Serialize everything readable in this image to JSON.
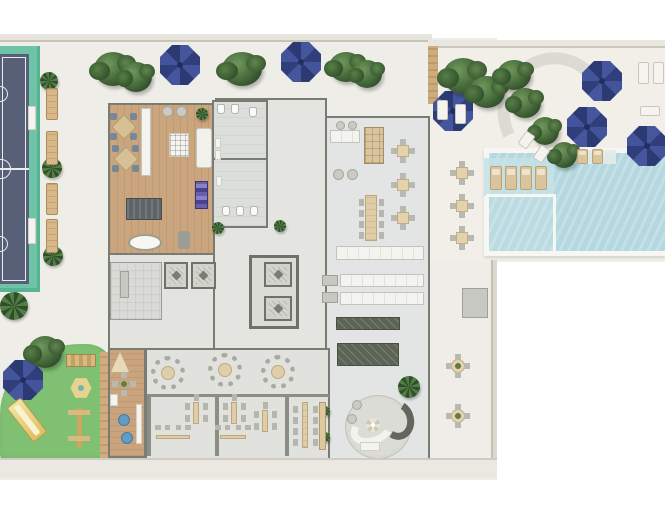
{
  "meta": {
    "description": "Top-down architectural floor plan rendering of a residential amenities level",
    "canvas": {
      "width": 665,
      "height": 515
    }
  },
  "palette": {
    "background": "#ffffff",
    "terrace": "#efede7",
    "court_surface": "#586078",
    "court_border": "#6fc3a6",
    "court_lines": "#e8ecf2",
    "wood_floor": "#caa57d",
    "building_floor": "#e3e4e1",
    "wall": "#787c72",
    "pool_water": "#b4d8df",
    "pool_coping": "#f7f6f2",
    "lawn": "#7fc073",
    "umbrella_navy": "#3a4a8c",
    "tree_green": "#4a6f3e",
    "furniture_tan": "#e0cda6",
    "dark_counter": "#5c6456",
    "kids_pouf_blue": "#5f9dc4",
    "play_equipment_yellow": "#e2c771"
  },
  "areas": [
    {
      "name": "sports-court",
      "bbox": [
        0,
        46,
        40,
        246
      ]
    },
    {
      "name": "planter-bench-row",
      "bbox": [
        46,
        88,
        12,
        165
      ]
    },
    {
      "name": "terrace-main",
      "bbox": [
        0,
        38,
        497,
        442
      ]
    },
    {
      "name": "multipurpose-room-wood-floor",
      "bbox": [
        108,
        103,
        107,
        152
      ]
    },
    {
      "name": "restrooms-block",
      "bbox": [
        212,
        100,
        56,
        128
      ]
    },
    {
      "name": "corridor",
      "bbox": [
        265,
        128,
        62,
        110
      ]
    },
    {
      "name": "cafe-lounge-wing",
      "bbox": [
        325,
        116,
        105,
        140
      ]
    },
    {
      "name": "kitchen-service",
      "bbox": [
        322,
        240,
        108,
        130
      ]
    },
    {
      "name": "elevator-core",
      "bbox": [
        160,
        255,
        140,
        75
      ]
    },
    {
      "name": "dining-hall",
      "bbox": [
        145,
        348,
        285,
        112
      ]
    },
    {
      "name": "private-dining-booths",
      "bbox": [
        147,
        394,
        182,
        62
      ]
    },
    {
      "name": "kids-playroom",
      "bbox": [
        108,
        348,
        38,
        110
      ]
    },
    {
      "name": "circular-lounge",
      "bbox": [
        345,
        395,
        66,
        64
      ]
    },
    {
      "name": "playground-lawn",
      "bbox": [
        0,
        344,
        112,
        120
      ]
    },
    {
      "name": "pool",
      "bbox": [
        484,
        148,
        181,
        108
      ]
    },
    {
      "name": "pool-deck",
      "bbox": [
        430,
        40,
        235,
        222
      ]
    },
    {
      "name": "outdoor-dining-east",
      "bbox": [
        440,
        155,
        50,
        100
      ]
    },
    {
      "name": "outdoor-tables-southeast",
      "bbox": [
        440,
        350,
        50,
        90
      ]
    }
  ],
  "counts": {
    "navy_umbrellas": 7,
    "round_tables_6_seat": 3,
    "square_tables_4_seat": 6,
    "round_tables_4_seat": 3,
    "pool_in_water_loungers": 4,
    "elevators": 4
  },
  "sprites": [
    {
      "t": "umbrella",
      "n": "terrace-umbrella",
      "x": 160,
      "y": 45
    },
    {
      "t": "umbrella",
      "n": "terrace-umbrella",
      "x": 281,
      "y": 42
    },
    {
      "t": "umbrella",
      "n": "pool-deck-umbrella",
      "x": 433,
      "y": 91
    },
    {
      "t": "umbrella",
      "n": "pool-deck-umbrella",
      "x": 582,
      "y": 61
    },
    {
      "t": "umbrella",
      "n": "pool-deck-umbrella",
      "x": 567,
      "y": 107
    },
    {
      "t": "umbrella",
      "n": "pool-deck-umbrella",
      "x": 627,
      "y": 126
    },
    {
      "t": "umbrella",
      "n": "lawn-umbrella",
      "x": 3,
      "y": 360
    },
    {
      "t": "tree",
      "x": 94,
      "y": 52,
      "w": 38,
      "h": 34
    },
    {
      "t": "tree",
      "x": 120,
      "y": 62,
      "w": 32,
      "h": 30
    },
    {
      "t": "tree",
      "x": 222,
      "y": 52,
      "w": 40,
      "h": 34
    },
    {
      "t": "tree",
      "x": 329,
      "y": 52,
      "w": 34,
      "h": 30
    },
    {
      "t": "tree",
      "x": 352,
      "y": 60,
      "w": 30,
      "h": 28
    },
    {
      "t": "tree",
      "x": 443,
      "y": 58,
      "w": 40,
      "h": 36
    },
    {
      "t": "tree",
      "x": 469,
      "y": 76,
      "w": 36,
      "h": 32
    },
    {
      "t": "tree",
      "x": 497,
      "y": 60,
      "w": 34,
      "h": 30
    },
    {
      "t": "tree",
      "x": 509,
      "y": 88,
      "w": 32,
      "h": 30
    },
    {
      "t": "tree",
      "x": 531,
      "y": 117,
      "w": 28,
      "h": 28
    },
    {
      "t": "tree",
      "x": 551,
      "y": 142,
      "w": 26,
      "h": 26
    },
    {
      "t": "tree",
      "x": 28,
      "y": 336,
      "w": 34,
      "h": 32
    },
    {
      "t": "palm",
      "x": 0,
      "y": 292,
      "w": 28,
      "h": 28
    },
    {
      "t": "palm",
      "x": 40,
      "y": 72,
      "w": 18,
      "h": 18
    },
    {
      "t": "palm",
      "x": 42,
      "y": 158,
      "w": 20,
      "h": 20
    },
    {
      "t": "palm",
      "x": 43,
      "y": 246,
      "w": 20,
      "h": 20
    },
    {
      "t": "palm",
      "x": 196,
      "y": 108,
      "w": 12,
      "h": 12
    },
    {
      "t": "palm",
      "x": 212,
      "y": 222,
      "w": 12,
      "h": 12
    },
    {
      "t": "palm",
      "x": 274,
      "y": 220,
      "w": 12,
      "h": 12
    },
    {
      "t": "palm",
      "x": 398,
      "y": 376,
      "w": 22,
      "h": 22
    },
    {
      "t": "palm",
      "x": 320,
      "y": 406,
      "w": 10,
      "h": 10
    },
    {
      "t": "palm",
      "x": 320,
      "y": 432,
      "w": 10,
      "h": 10
    },
    {
      "t": "bench",
      "x": 46,
      "y": 88,
      "w": 12,
      "h": 32
    },
    {
      "t": "bench",
      "x": 46,
      "y": 131,
      "w": 12,
      "h": 34
    },
    {
      "t": "bench",
      "x": 46,
      "y": 183,
      "w": 12,
      "h": 32
    },
    {
      "t": "bench",
      "x": 46,
      "y": 219,
      "w": 12,
      "h": 34
    },
    {
      "t": "pad",
      "x": 28,
      "y": 106,
      "w": 8,
      "h": 24
    },
    {
      "t": "pad",
      "x": 28,
      "y": 218,
      "w": 8,
      "h": 26
    },
    {
      "t": "lounger",
      "n": "pool-lounger",
      "x": 490,
      "y": 166,
      "w": 12,
      "h": 24
    },
    {
      "t": "lounger",
      "n": "pool-lounger",
      "x": 505,
      "y": 166,
      "w": 12,
      "h": 24
    },
    {
      "t": "lounger",
      "n": "pool-lounger",
      "x": 520,
      "y": 166,
      "w": 12,
      "h": 24
    },
    {
      "t": "lounger",
      "n": "pool-lounger",
      "x": 535,
      "y": 166,
      "w": 12,
      "h": 24
    },
    {
      "t": "lounger",
      "x": 577,
      "y": 149,
      "w": 11,
      "h": 15
    },
    {
      "t": "lounger",
      "x": 592,
      "y": 149,
      "w": 11,
      "h": 15
    },
    {
      "t": "lounger-w",
      "x": 638,
      "y": 62,
      "w": 11,
      "h": 22
    },
    {
      "t": "lounger-w",
      "x": 653,
      "y": 62,
      "w": 11,
      "h": 22
    },
    {
      "t": "lounger-w",
      "x": 640,
      "y": 106,
      "w": 20,
      "h": 10
    },
    {
      "t": "lounger-w",
      "x": 437,
      "y": 100,
      "w": 11,
      "h": 20
    },
    {
      "t": "lounger-w",
      "x": 455,
      "y": 104,
      "w": 11,
      "h": 20
    },
    {
      "t": "lounger-w",
      "x": 521,
      "y": 132,
      "w": 11,
      "h": 16,
      "r": 35
    },
    {
      "t": "lounger-w",
      "x": 536,
      "y": 146,
      "w": 11,
      "h": 16,
      "r": 35
    },
    {
      "t": "table4",
      "n": "outdoor-table",
      "x": 452,
      "y": 163
    },
    {
      "t": "table4",
      "n": "outdoor-table",
      "x": 452,
      "y": 196
    },
    {
      "t": "table4",
      "n": "outdoor-table",
      "x": 452,
      "y": 228
    },
    {
      "t": "table-r4",
      "n": "outdoor-round-table",
      "x": 447,
      "y": 355
    },
    {
      "t": "table-r4",
      "n": "outdoor-round-table",
      "x": 447,
      "y": 405
    },
    {
      "t": "table4",
      "n": "cafe-table",
      "x": 393,
      "y": 141
    },
    {
      "t": "table4",
      "n": "cafe-table",
      "x": 393,
      "y": 175
    },
    {
      "t": "table4",
      "n": "cafe-table",
      "x": 393,
      "y": 208
    },
    {
      "t": "longtable",
      "n": "communal-table",
      "x": 359,
      "y": 193,
      "w": 24,
      "h": 50
    },
    {
      "t": "chair",
      "x": 336,
      "y": 121,
      "w": 9,
      "h": 9
    },
    {
      "t": "chair",
      "x": 348,
      "y": 121,
      "w": 9,
      "h": 9
    },
    {
      "t": "counter",
      "x": 330,
      "y": 130,
      "w": 30,
      "h": 13
    },
    {
      "t": "cabinet",
      "x": 364,
      "y": 127,
      "w": 20,
      "h": 37
    },
    {
      "t": "chair",
      "x": 333,
      "y": 169,
      "w": 11,
      "h": 11
    },
    {
      "t": "chair",
      "x": 347,
      "y": 169,
      "w": 11,
      "h": 11
    },
    {
      "t": "counter",
      "x": 336,
      "y": 246,
      "w": 88,
      "h": 14
    },
    {
      "t": "counter",
      "x": 340,
      "y": 274,
      "w": 84,
      "h": 13
    },
    {
      "t": "counter",
      "x": 340,
      "y": 292,
      "w": 84,
      "h": 13
    },
    {
      "t": "graybox",
      "x": 322,
      "y": 275,
      "w": 16,
      "h": 11
    },
    {
      "t": "graybox",
      "x": 322,
      "y": 292,
      "w": 16,
      "h": 11
    },
    {
      "t": "darkcounter",
      "n": "kitchen-island",
      "x": 336,
      "y": 317,
      "w": 64,
      "h": 13
    },
    {
      "t": "darkcounter",
      "n": "buffet-counter",
      "x": 337,
      "y": 343,
      "w": 62,
      "h": 23
    },
    {
      "t": "xdesk",
      "n": "workstation-cluster",
      "x": 108,
      "y": 112,
      "w": 30,
      "h": 28
    },
    {
      "t": "xdesk",
      "n": "workstation-cluster",
      "x": 110,
      "y": 144,
      "w": 30,
      "h": 28
    },
    {
      "t": "counter",
      "x": 141,
      "y": 108,
      "w": 10,
      "h": 68
    },
    {
      "t": "gridtable",
      "x": 169,
      "y": 133,
      "w": 20,
      "h": 24
    },
    {
      "t": "sofa",
      "x": 196,
      "y": 128,
      "w": 16,
      "h": 40
    },
    {
      "t": "rack",
      "n": "equipment-rack",
      "x": 195,
      "y": 181,
      "w": 13,
      "h": 28
    },
    {
      "t": "darktable",
      "x": 126,
      "y": 198,
      "w": 36,
      "h": 22
    },
    {
      "t": "oval",
      "n": "massage-table",
      "x": 128,
      "y": 234,
      "w": 34,
      "h": 17
    },
    {
      "t": "stool",
      "x": 178,
      "y": 231,
      "w": 12,
      "h": 18
    },
    {
      "t": "chair",
      "x": 162,
      "y": 106,
      "w": 11,
      "h": 11
    },
    {
      "t": "chair",
      "x": 176,
      "y": 106,
      "w": 11,
      "h": 11
    },
    {
      "t": "table-r6",
      "n": "dining-round-table",
      "x": 151,
      "y": 356
    },
    {
      "t": "table-r6",
      "n": "dining-round-table",
      "x": 208,
      "y": 353
    },
    {
      "t": "table-r6",
      "n": "dining-round-table",
      "x": 261,
      "y": 355
    },
    {
      "t": "vtable",
      "n": "booth-table",
      "x": 190,
      "y": 400,
      "w": 12,
      "h": 26
    },
    {
      "t": "vtable",
      "n": "booth-table",
      "x": 228,
      "y": 400,
      "w": 12,
      "h": 26
    },
    {
      "t": "vtable",
      "n": "booth-table",
      "x": 259,
      "y": 408,
      "w": 12,
      "h": 26
    },
    {
      "t": "banquette",
      "x": 154,
      "y": 431,
      "w": 38,
      "h": 12
    },
    {
      "t": "banquette",
      "x": 218,
      "y": 431,
      "w": 30,
      "h": 12
    },
    {
      "t": "longtable",
      "n": "dining-long-table",
      "x": 298,
      "y": 400,
      "w": 14,
      "h": 50
    },
    {
      "t": "console",
      "x": 319,
      "y": 402,
      "w": 7,
      "h": 48
    },
    {
      "t": "teepee",
      "x": 111,
      "y": 352,
      "w": 18,
      "h": 20
    },
    {
      "t": "table-r4",
      "n": "kids-table",
      "x": 116,
      "y": 376,
      "w": 16,
      "h": 16
    },
    {
      "t": "pad",
      "x": 110,
      "y": 394,
      "w": 8,
      "h": 12
    },
    {
      "t": "pad",
      "x": 136,
      "y": 404,
      "w": 6,
      "h": 40
    },
    {
      "t": "pouf",
      "x": 118,
      "y": 414
    },
    {
      "t": "pouf",
      "x": 121,
      "y": 432
    },
    {
      "t": "slide",
      "n": "playground-slide",
      "x": 18,
      "y": 398,
      "w": 18,
      "h": 44,
      "r": -38
    },
    {
      "t": "woodbar",
      "n": "climbing-frame",
      "x": 66,
      "y": 354,
      "w": 30,
      "h": 13
    },
    {
      "t": "hex",
      "n": "play-hexagon",
      "x": 70,
      "y": 377
    },
    {
      "t": "seesaw",
      "n": "play-structure",
      "x": 66,
      "y": 406,
      "w": 26,
      "h": 44
    },
    {
      "t": "elev",
      "n": "elevator",
      "x": 164,
      "y": 262,
      "w": 24,
      "h": 27
    },
    {
      "t": "elev",
      "n": "elevator",
      "x": 191,
      "y": 262,
      "w": 25,
      "h": 27
    },
    {
      "t": "elev",
      "n": "elevator",
      "x": 264,
      "y": 262,
      "w": 28,
      "h": 25
    },
    {
      "t": "elev",
      "n": "elevator",
      "x": 264,
      "y": 296,
      "w": 28,
      "h": 25
    },
    {
      "t": "graybox",
      "x": 120,
      "y": 271,
      "w": 9,
      "h": 27
    },
    {
      "t": "wc",
      "x": 217,
      "y": 104
    },
    {
      "t": "wc",
      "x": 231,
      "y": 104
    },
    {
      "t": "wc",
      "x": 249,
      "y": 107
    },
    {
      "t": "pad",
      "x": 215,
      "y": 138,
      "w": 6,
      "h": 10
    },
    {
      "t": "pad",
      "x": 215,
      "y": 150,
      "w": 6,
      "h": 10
    },
    {
      "t": "pad",
      "x": 216,
      "y": 176,
      "w": 6,
      "h": 10
    },
    {
      "t": "wc",
      "x": 222,
      "y": 206
    },
    {
      "t": "wc",
      "x": 236,
      "y": 206
    },
    {
      "t": "wc",
      "x": 250,
      "y": 206
    },
    {
      "t": "arcsofa-w",
      "x": 350,
      "y": 414,
      "w": 44,
      "h": 30
    },
    {
      "t": "arcsofa-d",
      "x": 380,
      "y": 400,
      "w": 34,
      "h": 40
    },
    {
      "t": "flower",
      "x": 366,
      "y": 418,
      "w": 14,
      "h": 14
    },
    {
      "t": "chair",
      "x": 352,
      "y": 400
    },
    {
      "t": "chair",
      "x": 347,
      "y": 414
    },
    {
      "t": "pad",
      "x": 360,
      "y": 442,
      "w": 20,
      "h": 9
    },
    {
      "t": "graybox",
      "n": "deck-planter",
      "x": 462,
      "y": 288,
      "w": 26,
      "h": 30
    }
  ]
}
